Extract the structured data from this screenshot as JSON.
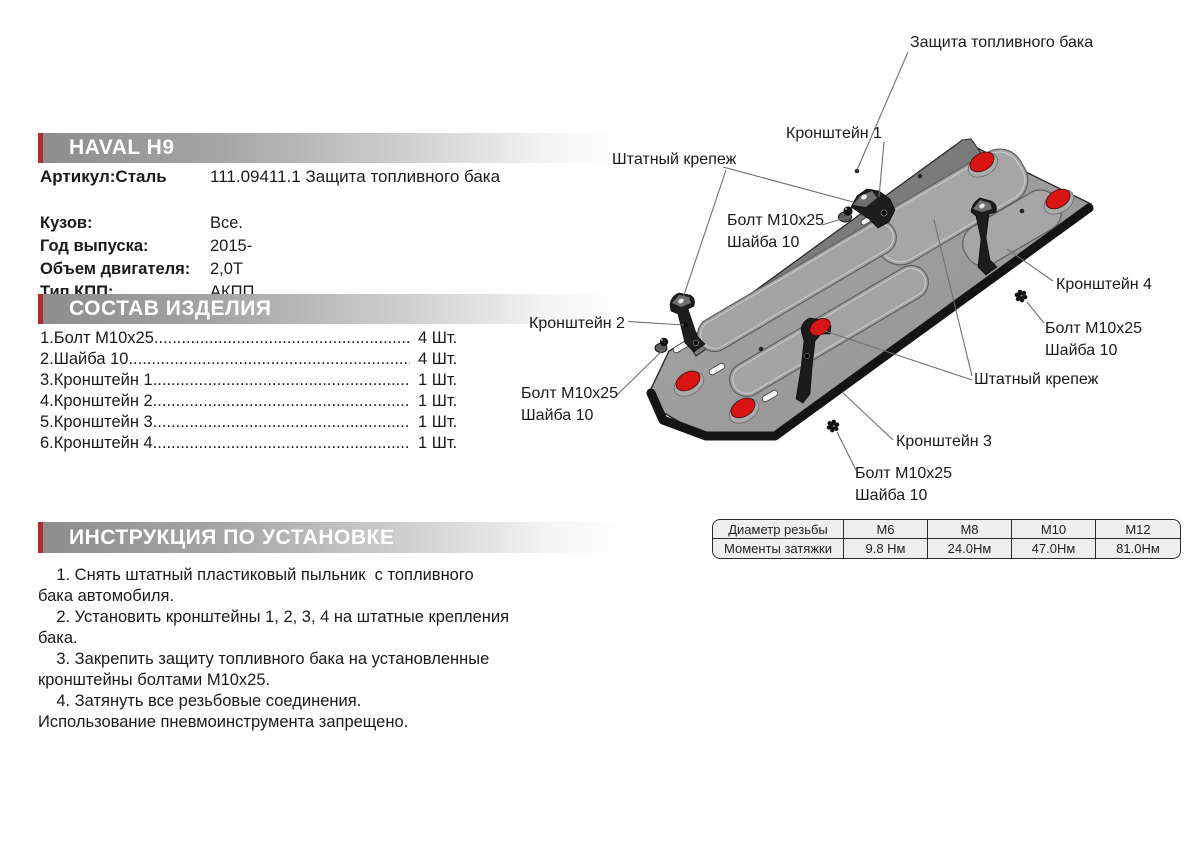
{
  "colors": {
    "accent_red": "#b02a30",
    "hole_red": "#d81414",
    "plate_gray": "#9b9b9b",
    "text": "#1a1a1a"
  },
  "header": {
    "brand": "HAVAL H9",
    "article_label": "Артикул:Сталь",
    "article_value": "111.09411.1 Защита топливного бака"
  },
  "specs": {
    "rows": [
      {
        "label": "Кузов:",
        "value": "Все."
      },
      {
        "label": "Год выпуска:",
        "value": "2015-"
      },
      {
        "label": "Объем двигателя:",
        "value": "2,0Т"
      },
      {
        "label": "Тип КПП:",
        "value": "АКПП"
      }
    ]
  },
  "parts": {
    "title": "СОСТАВ ИЗДЕЛИЯ",
    "dots": "................................................................................",
    "items": [
      {
        "name": "1.Болт M10x25",
        "qty": "4 Шт."
      },
      {
        "name": "2.Шайба 10",
        "qty": "4 Шт."
      },
      {
        "name": "3.Кронштейн 1",
        "qty": "1 Шт."
      },
      {
        "name": "4.Кронштейн 2",
        "qty": "1 Шт."
      },
      {
        "name": "5.Кронштейн 3",
        "qty": "1 Шт."
      },
      {
        "name": "6.Кронштейн 4",
        "qty": "1 Шт."
      }
    ]
  },
  "instructions": {
    "title": "ИНСТРУКЦИЯ ПО УСТАНОВКЕ",
    "lines": [
      "    1. Снять штатный пластиковый пыльник  с топливного",
      "бака автомобиля.",
      "    2. Установить кронштейны 1, 2, 3, 4 на штатные крепления",
      "бака.",
      "    3. Закрепить защиту топливного бака на установленные",
      "кронштейны болтами M10x25.",
      "    4. Затянуть все резьбовые соединения.",
      "Использование пневмоинструмента запрещено."
    ]
  },
  "diagram": {
    "labels": {
      "shield": "Защита топливного бака",
      "bracket1": "Кронштейн 1",
      "bracket2": "Кронштейн 2",
      "bracket3": "Кронштейн 3",
      "bracket4": "Кронштейн 4",
      "stock_left": "Штатный крепеж",
      "stock_right": "Штатный крепеж",
      "bolt_top": "Болт M10x25\nШайба 10",
      "bolt_left": "Болт M10x25\nШайба 10",
      "bolt_right": "Болт M10x25\nШайба 10",
      "bolt_bottom": "Болт M10x25\nШайба 10"
    }
  },
  "torque_table": {
    "header_row": [
      "Диаметр резьбы",
      "M6",
      "M8",
      "M10",
      "M12"
    ],
    "value_row": [
      "Моменты затяжки",
      "9.8 Нм",
      "24.0Нм",
      "47.0Нм",
      "81.0Нм"
    ]
  }
}
